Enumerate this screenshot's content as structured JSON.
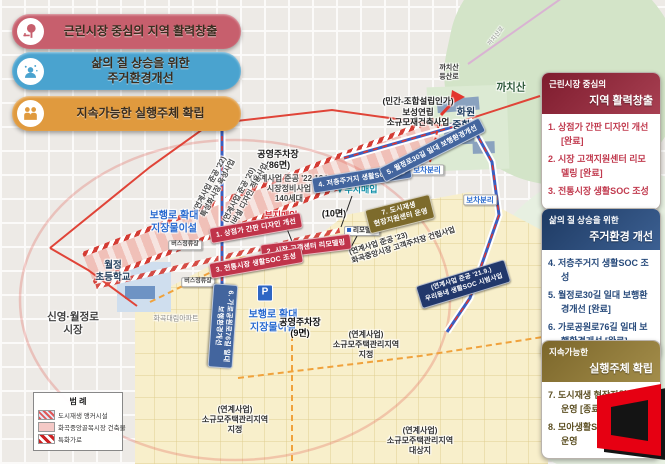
{
  "goals": {
    "items": [
      {
        "icon": "tree-bench-icon",
        "label": "근린시장 중심의 지역 활력창출",
        "color": "#c75f6d"
      },
      {
        "icon": "resident-icon",
        "label": "삶의 질 상승을 위한\n주거환경개선",
        "color": "#4aa3cf"
      },
      {
        "icon": "partners-handshake-icon",
        "label": "지속가능한 실행주체 확립",
        "color": "#e09a3e"
      }
    ]
  },
  "panels": [
    {
      "title_top": "근린시장 중심의",
      "title_main": "지역 활력창출",
      "accent": "#8d2136",
      "items": [
        {
          "text": "1. 상점가 간판 디자인 개선 [완료]"
        },
        {
          "text": "2. 시장 고객지원센터 리모델링 [완료]"
        },
        {
          "text": "3. 전통시장 생활SOC 조성"
        }
      ]
    },
    {
      "title_top": "삶의 질 상승을 위한",
      "title_main": "주거환경 개선",
      "accent": "#274a7b",
      "items": [
        {
          "text": "4. 저층주거지 생활SOC 조성"
        },
        {
          "text": "5. 월정로30길 일대 보행환경개선 [완료]"
        },
        {
          "text": "6. 가로공원로76길 일대 보행환경개선 [완료]"
        }
      ]
    },
    {
      "title_top": "지속가능한",
      "title_main": "실행주체 확립",
      "accent": "#8a7331",
      "items": [
        {
          "text": "7. 도시재생 현장지원센터 운영 [종료]"
        },
        {
          "text": "8. 모아생활SOC 협동조합 운영"
        }
      ]
    }
  ],
  "legend": {
    "title": "범 례",
    "items": [
      {
        "swatch": "anchor-facility-swatch",
        "label": "도시재생 앵커시설"
      },
      {
        "swatch": "market-building-swatch",
        "label": "화곡중앙골목시장 건축물"
      },
      {
        "swatch": "special-street-swatch",
        "label": "특화가로"
      }
    ]
  },
  "map": {
    "banners": [
      {
        "text": "1. 상점가 간판 디자인 개선",
        "color": "#c0344a"
      },
      {
        "text": "2. 시장 고객센터 리모델링",
        "color": "#c0344a"
      },
      {
        "text": "3. 전통시장 생활SOC 조성",
        "color": "#c0344a"
      },
      {
        "text": "4. 저층주거지 생활SOC 조성",
        "color": "#43659e"
      },
      {
        "text": "5. 월정로30길 일대 보행환경개선",
        "color": "#43659e"
      },
      {
        "text": "6. 가로공원로76길 일대\n보행환경개선",
        "color": "#43659e"
      },
      {
        "text": "7. 도시재생\n현장지원센터 운영",
        "color": "#7d6b2c"
      },
      {
        "text": "(연계사업 준공 '21.9.)\n우리동네 생활SOC 시범사업",
        "color": "#22386b"
      }
    ],
    "labels": [
      {
        "text": "공영주차장\n(86면)"
      },
      {
        "text": "(연계사업 준공 '22.12.)\n시장정비사업\n140세대"
      },
      {
        "text": "(연계사업 준공 '22)\n특성화시장 육성사업"
      },
      {
        "text": "(연계사업 준공 '20)\n유니버설 디자인 적용사업"
      },
      {
        "text": "(연계사업 준공 '23)\n화곡중앙시장 고객주차장 건립사업"
      },
      {
        "text": "보행로 확대\n지장물이설"
      },
      {
        "text": "보행로 확대\n지장물이설"
      },
      {
        "text": "월정\n초등학교"
      },
      {
        "text": "신영·월정로\n시장"
      },
      {
        "text": "화곡대림아파트"
      },
      {
        "text": "버스정류장"
      },
      {
        "text": "버스정류장"
      },
      {
        "text": "까치산\n등산로"
      },
      {
        "text": "까치산"
      },
      {
        "text": "화원\n중학교"
      },
      {
        "text": "(민간-조합설립인가)\n보성연립\n소규모재건축사업"
      },
      {
        "text": "보차분리"
      },
      {
        "text": "보차분리"
      },
      {
        "text": "(10면)"
      },
      {
        "text": "리모델링"
      },
      {
        "text": "부지매입"
      },
      {
        "text": "부지매입"
      },
      {
        "text": "공영주차장\n(9면)"
      },
      {
        "text": "(연계사업)\n소규모주택관리지역\n지정"
      },
      {
        "text": "(연계사업)\n소규모주택관리지역\n지정"
      },
      {
        "text": "(연계사업)\n소규모주택관리지역\n대상지"
      },
      {
        "text": "P"
      },
      {
        "text": "까치산로"
      }
    ]
  }
}
